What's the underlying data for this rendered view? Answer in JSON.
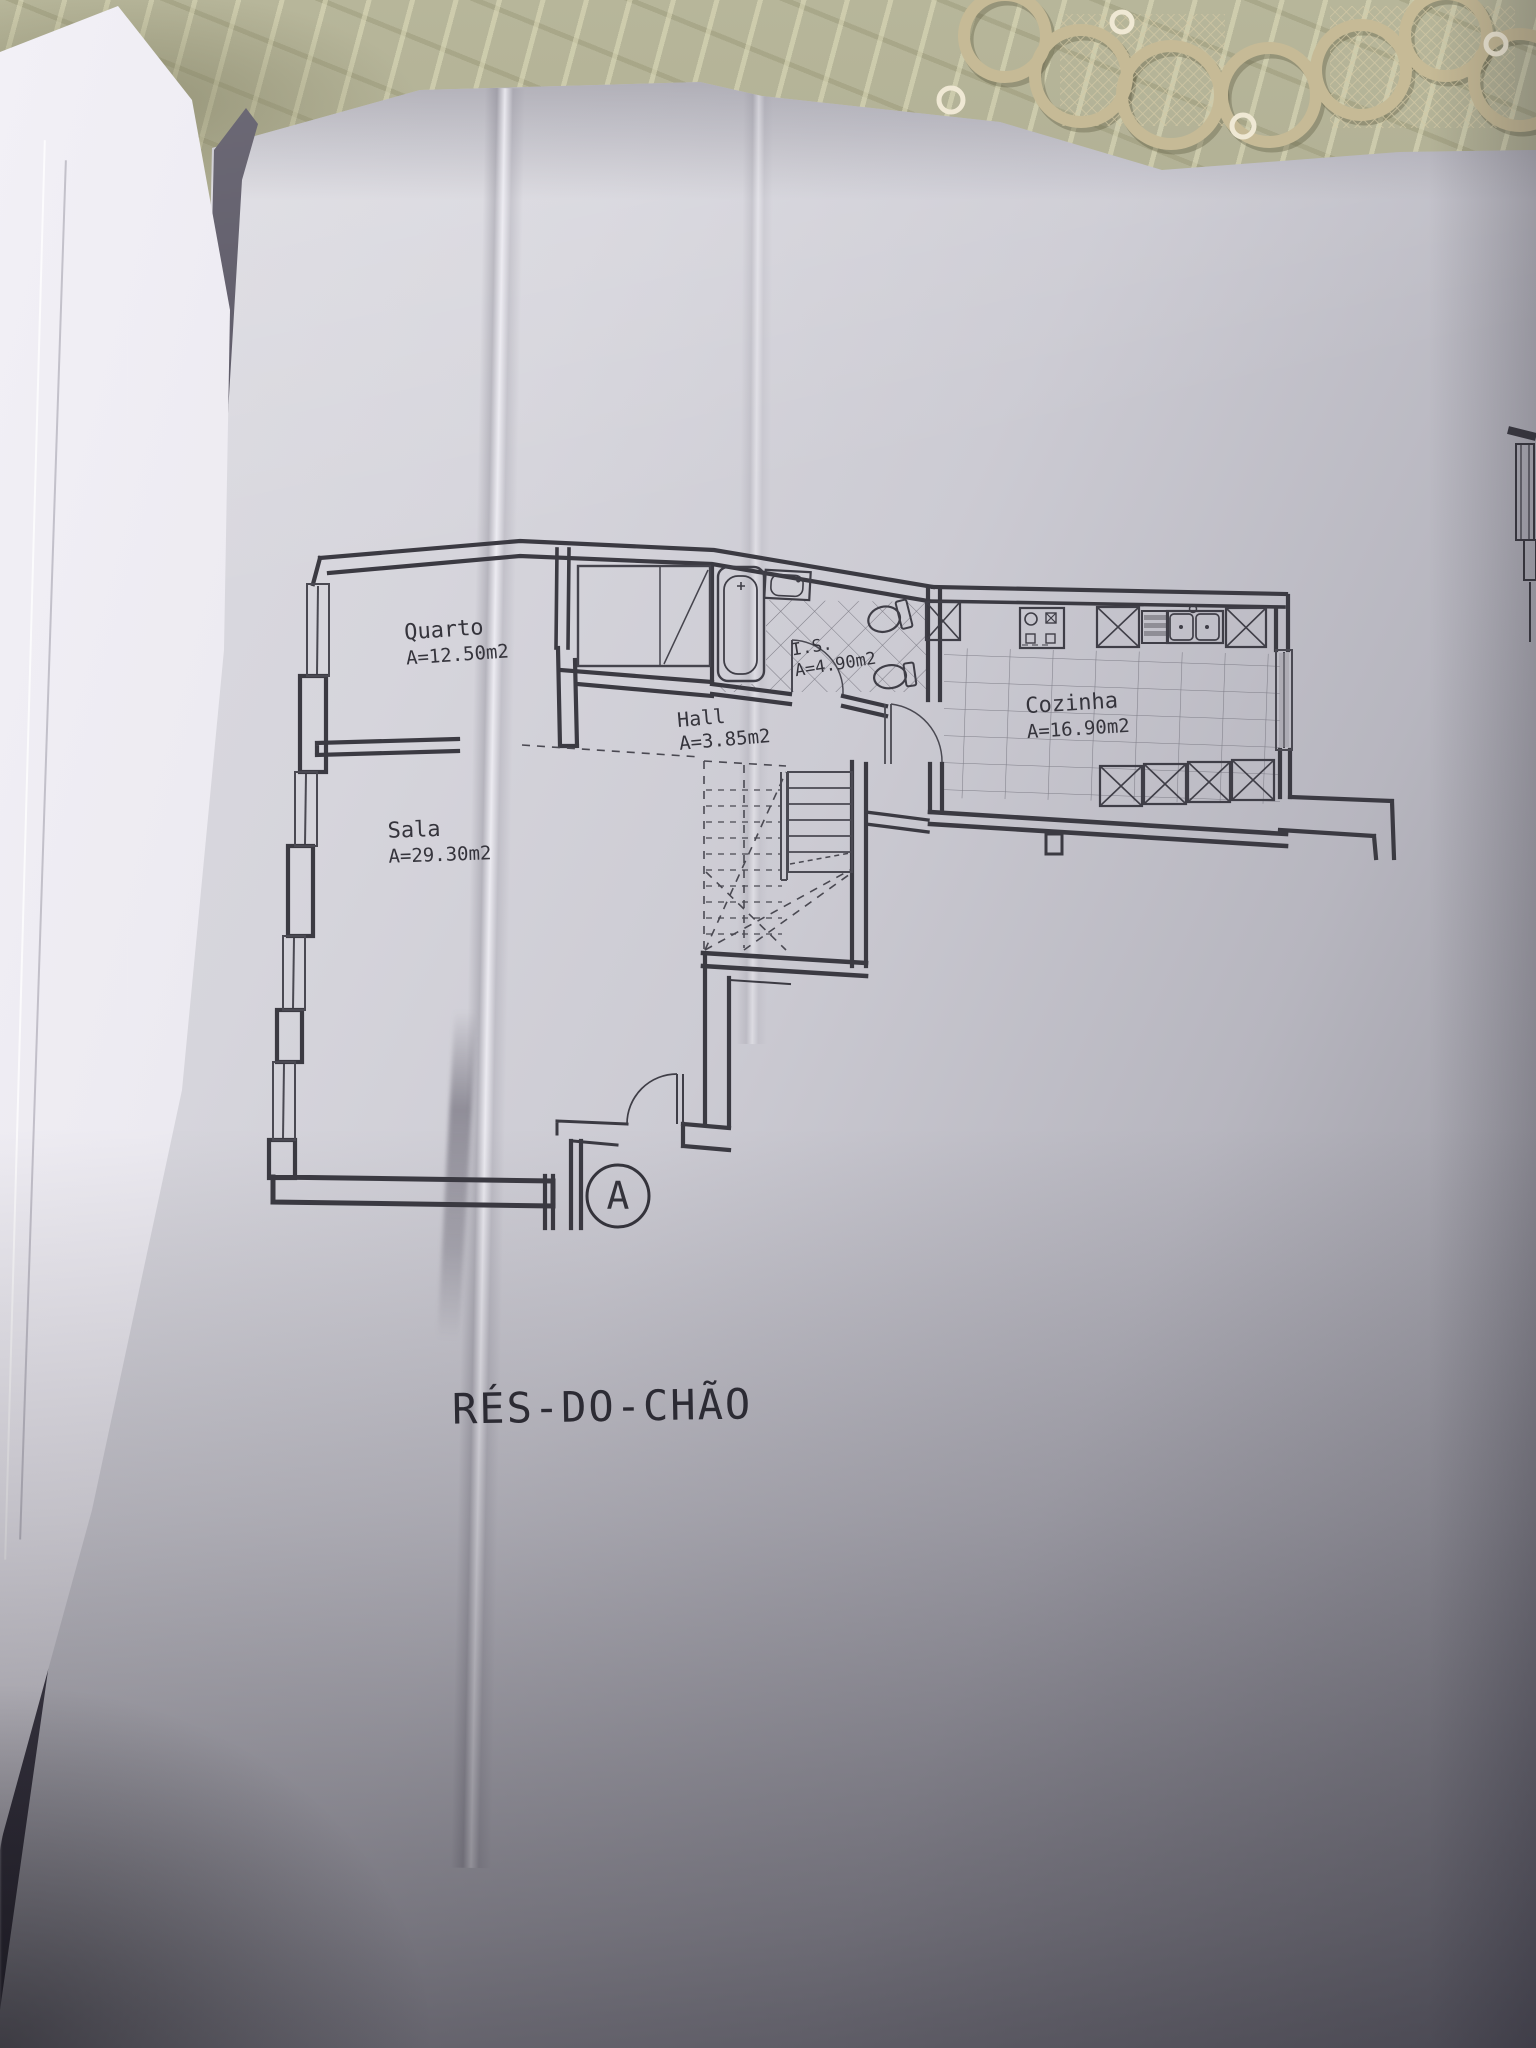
{
  "scene": {
    "description": "Photograph of an open folder of architectural drawings lying on a patterned tablecloth with a lace doily",
    "tablecloth_color": "#b5b499",
    "doily_color": "#cabe9b",
    "paper_color": "#cfced5",
    "ink_color": "#3b3a42"
  },
  "floor_plan": {
    "title": "RÉS-DO-CHÃO",
    "section_marker": "A",
    "rooms": [
      {
        "name": "Quarto",
        "area": "A=12.50m2"
      },
      {
        "name": "Sala",
        "area": "A=29.30m2"
      },
      {
        "name": "Hall",
        "area": "A=3.85m2"
      },
      {
        "name": "I.S.",
        "area": "A=4.90m2"
      },
      {
        "name": "Cozinha",
        "area": "A=16.90m2"
      }
    ],
    "fixtures": [
      "bathtub",
      "washbasin",
      "toilet",
      "bidet",
      "wardrobe",
      "stove",
      "oven",
      "dishwasher",
      "double-sink",
      "counter-unit",
      "stairs",
      "entrance-door",
      "window"
    ]
  }
}
